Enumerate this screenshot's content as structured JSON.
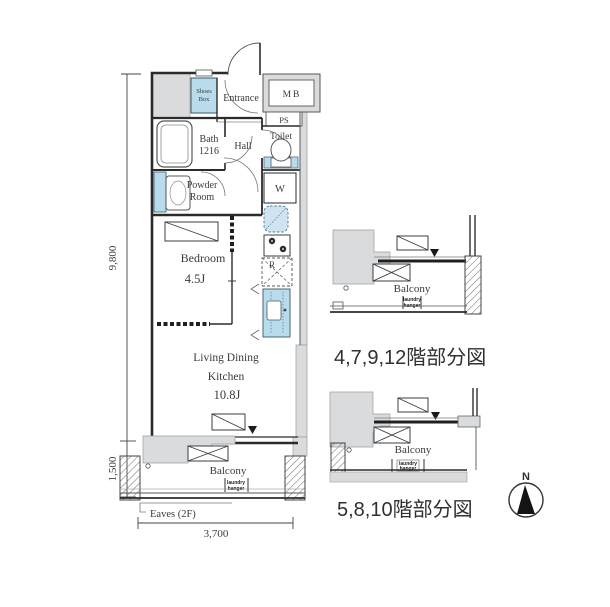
{
  "colors": {
    "fixture_blue": "#b8dcec",
    "fixture_blue_light": "#cfe4f0",
    "wall_gray": "#d9dbdd",
    "line_dark": "#2b2b2b",
    "text_dark": "#3a3a3a"
  },
  "main_plan": {
    "rooms": {
      "shoes_box_line1": "Shoes",
      "shoes_box_line2": "Box",
      "entrance": "Entrance",
      "meter_box": "MB",
      "pipe_space": "PS",
      "bath_line1": "Bath",
      "bath_line2": "1216",
      "hall": "Hall",
      "toilet": "Toilet",
      "washer": "W",
      "powder_line1": "Powder",
      "powder_line2": "Room",
      "refrigerator": "R",
      "bedroom_line1": "Bedroom",
      "bedroom_line2": "4.5J",
      "ldk_line1": "Living Dining",
      "ldk_line2": "Kitchen",
      "ldk_line3": "10.8J",
      "balcony": "Balcony",
      "laundry_line1": "laundry",
      "laundry_line2": "hanger",
      "eaves": "Eaves (2F)"
    },
    "dimensions": {
      "left_upper": "9,800",
      "left_lower": "1,500",
      "bottom": "3,700"
    }
  },
  "partial_plans": [
    {
      "caption": "4,7,9,12階部分図",
      "balcony": "Balcony",
      "laundry_line1": "laundry",
      "laundry_line2": "hanger"
    },
    {
      "caption": "5,8,10階部分図",
      "balcony": "Balcony",
      "laundry_line1": "laundry",
      "laundry_line2": "hanger"
    }
  ],
  "compass": {
    "north_label": "N"
  }
}
